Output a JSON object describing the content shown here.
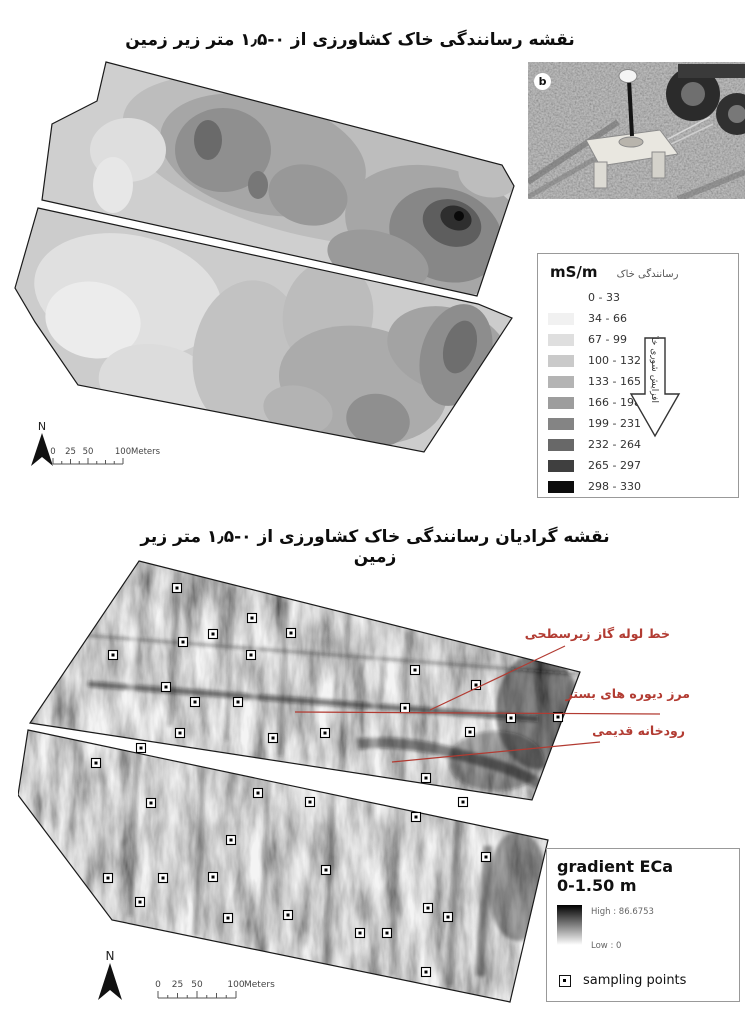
{
  "colors": {
    "annotation_red": "#b23b32",
    "map_outline": "#1a1a1a"
  },
  "top_figure": {
    "title": "نقشه رسانندگی خاک کشاورزی از ۰-۱٫۵ متر زیر زمین",
    "photo_label": "b",
    "legend": {
      "unit": "mS/m",
      "heading_fa": "رسانندگی خاک",
      "arrow_label_fa": "افزایش شوری خاک",
      "classes": [
        {
          "range": "0 - 33",
          "color": "#ffffff"
        },
        {
          "range": "34 - 66",
          "color": "#f1f1f1"
        },
        {
          "range": "67 - 99",
          "color": "#dfdfdf"
        },
        {
          "range": "100 - 132",
          "color": "#cacaca"
        },
        {
          "range": "133 - 165",
          "color": "#b4b4b4"
        },
        {
          "range": "166 - 198",
          "color": "#9d9d9d"
        },
        {
          "range": "199 - 231",
          "color": "#848484"
        },
        {
          "range": "232 - 264",
          "color": "#686868"
        },
        {
          "range": "265 - 297",
          "color": "#3f3f3f"
        },
        {
          "range": "298 - 330",
          "color": "#0c0c0c"
        }
      ]
    },
    "scalebar": {
      "labels": [
        "0",
        "25",
        "50",
        "100"
      ],
      "unit": "Meters",
      "north": "N"
    }
  },
  "bottom_figure": {
    "title": "نقشه گرادیان رسانندگی خاک کشاورزی از ۰-۱٫۵ متر زیر زمین",
    "annotations": [
      {
        "text": "خط لوله گاز زیرسطحی",
        "line": [
          547,
          90,
          412,
          154
        ]
      },
      {
        "text": "مرز دیوره های بستر",
        "line": [
          642,
          158,
          277,
          156
        ]
      },
      {
        "text": "رودخانه قدیمی",
        "line": [
          582,
          186,
          374,
          206
        ]
      }
    ],
    "legend": {
      "title_line1": "gradient ECa",
      "title_line2": "0-1.50 m",
      "high_label": "High : 86.6753",
      "low_label": "Low : 0",
      "points_label": "sampling points"
    },
    "scalebar": {
      "labels": [
        "0",
        "25",
        "50",
        "100"
      ],
      "unit": "Meters",
      "north": "N"
    },
    "sampling_points": [
      [
        159,
        32
      ],
      [
        234,
        62
      ],
      [
        195,
        78
      ],
      [
        273,
        77
      ],
      [
        165,
        86
      ],
      [
        95,
        99
      ],
      [
        233,
        99
      ],
      [
        148,
        131
      ],
      [
        177,
        146
      ],
      [
        220,
        146
      ],
      [
        397,
        114
      ],
      [
        458,
        129
      ],
      [
        387,
        152
      ],
      [
        493,
        162
      ],
      [
        540,
        161
      ],
      [
        307,
        177
      ],
      [
        162,
        177
      ],
      [
        255,
        182
      ],
      [
        452,
        176
      ],
      [
        123,
        192
      ],
      [
        78,
        207
      ],
      [
        408,
        222
      ],
      [
        240,
        237
      ],
      [
        292,
        246
      ],
      [
        445,
        246
      ],
      [
        133,
        247
      ],
      [
        213,
        284
      ],
      [
        398,
        261
      ],
      [
        90,
        322
      ],
      [
        145,
        322
      ],
      [
        195,
        321
      ],
      [
        308,
        314
      ],
      [
        468,
        301
      ],
      [
        122,
        346
      ],
      [
        210,
        362
      ],
      [
        270,
        359
      ],
      [
        342,
        377
      ],
      [
        410,
        352
      ],
      [
        430,
        361
      ],
      [
        369,
        377
      ],
      [
        408,
        416
      ]
    ]
  }
}
